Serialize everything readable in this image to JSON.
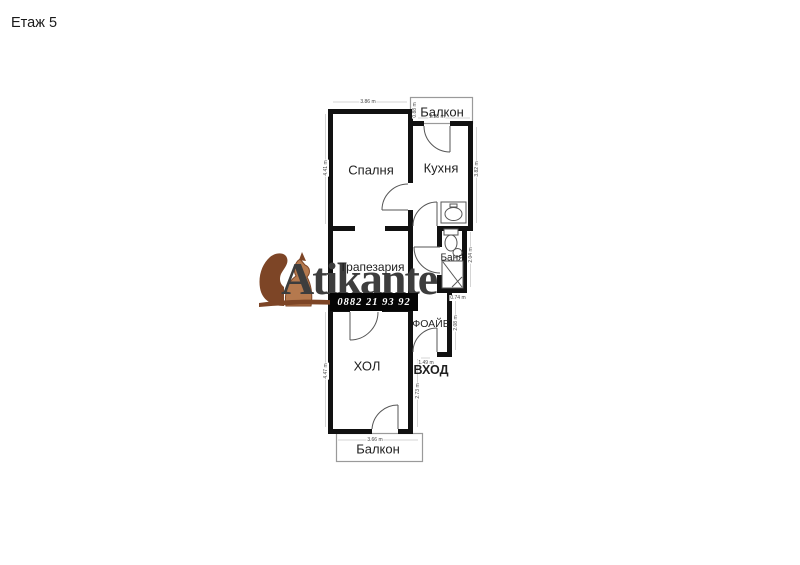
{
  "page": {
    "title": "Етаж 5"
  },
  "plan": {
    "rooms": {
      "balcony_top": "Балкон",
      "bedroom": "Спалня",
      "kitchen": "Кухня",
      "dining": "Трапезария",
      "bath": "Баня",
      "foyer": "ФОАЙЕ",
      "living": "ХОЛ",
      "balcony_bottom": "Балкон"
    },
    "entrance_label": "ВХОД",
    "dimensions": {
      "bedroom_top": "3.86 m",
      "bedroom_left": "4.41 m",
      "balcony_top_left": "0.88 m",
      "kitchen_top": "2.23 m",
      "kitchen_right": "3.82 m",
      "bath_right": "2.04 m",
      "bath_bottom": "0.74 m",
      "foyer_right": "2.08 m",
      "foyer_door": "1.49 m",
      "living_right": "2.73 m",
      "living_left": "4.47 m",
      "living_bottom": "3.66 m"
    },
    "colors": {
      "wall": "#111111",
      "balcony_rail": "#9a9a9a",
      "door_line": "#555555",
      "dim_text": "#444444"
    }
  },
  "logo": {
    "brand": "Atikante",
    "phone": "0882 21 93 92",
    "colors": {
      "fur_light": "#b5794e",
      "fur_dark": "#7d4526",
      "text": "#3d3d3d",
      "phone_bg": "#050505",
      "phone_text": "#ffffff"
    }
  }
}
